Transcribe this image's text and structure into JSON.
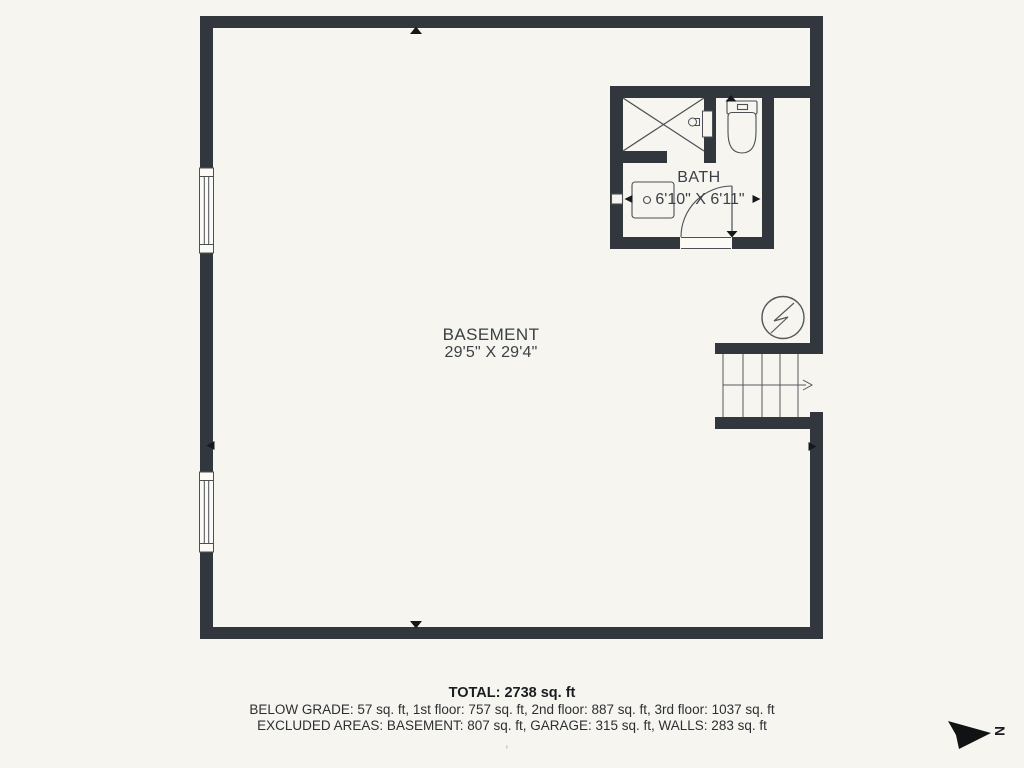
{
  "plan": {
    "rooms": [
      {
        "name": "BASEMENT",
        "dimensions": "29'5\" X 29'4\""
      },
      {
        "name": "BATH",
        "dimensions": "6'10\" X 6'11\""
      }
    ],
    "north_label": "N",
    "stray_mark": ","
  },
  "summary": {
    "total": "TOTAL: 2738 sq. ft",
    "floors": "BELOW GRADE: 57 sq. ft, 1st floor: 757 sq. ft, 2nd floor: 887 sq. ft, 3rd floor: 1037 sq. ft",
    "excluded": "EXCLUDED AREAS: BASEMENT: 807 sq. ft, GARAGE: 315 sq. ft, WALLS: 283 sq. ft"
  },
  "colors": {
    "background": "#f6f5ef",
    "wall": "#31373c",
    "thin_line": "#4b5055",
    "text": "#3b4046",
    "marker": "#16191c"
  }
}
